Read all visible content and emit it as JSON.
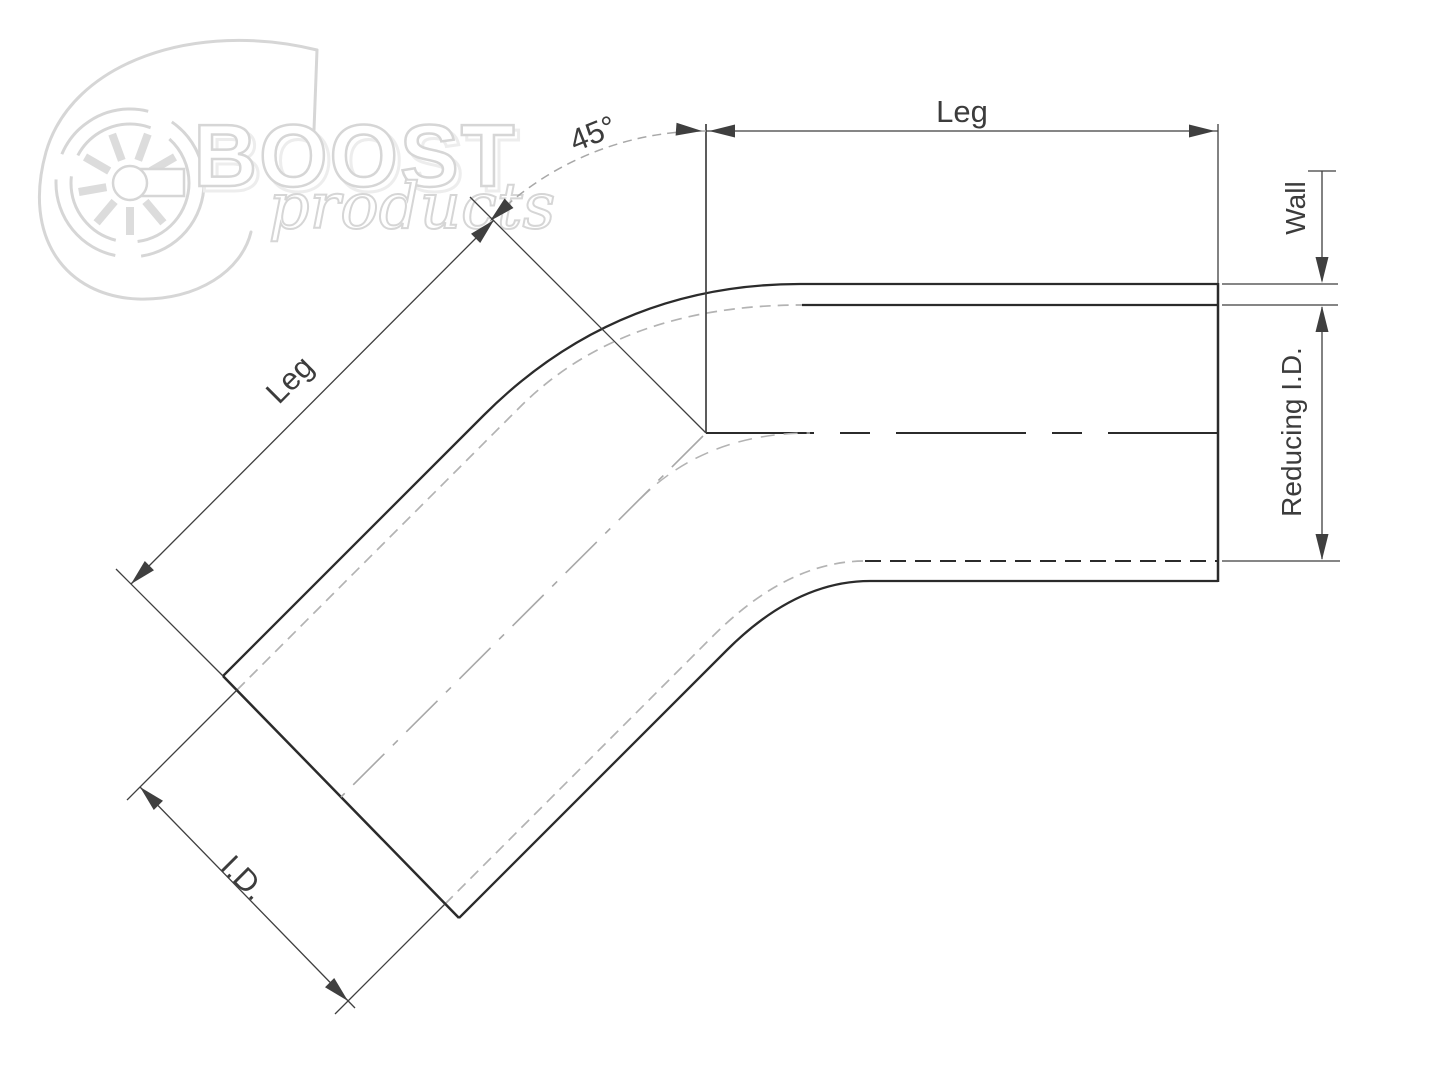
{
  "watermark": {
    "brand": "BOOST",
    "brand_sub": "products"
  },
  "labels": {
    "angle": "45°",
    "leg_top": "Leg",
    "leg_angled": "Leg",
    "wall": "Wall",
    "reducing_id": "Reducing I.D.",
    "inner_diameter": "I.D."
  },
  "colors": {
    "line": "#2b2b2b",
    "dim": "#3f3f3f",
    "hidden": "#b3b3b3",
    "centerlight": "#a8a8a8",
    "label": "#3c3c3c",
    "watermark": "#d6d6d6",
    "bg": "#ffffff"
  }
}
